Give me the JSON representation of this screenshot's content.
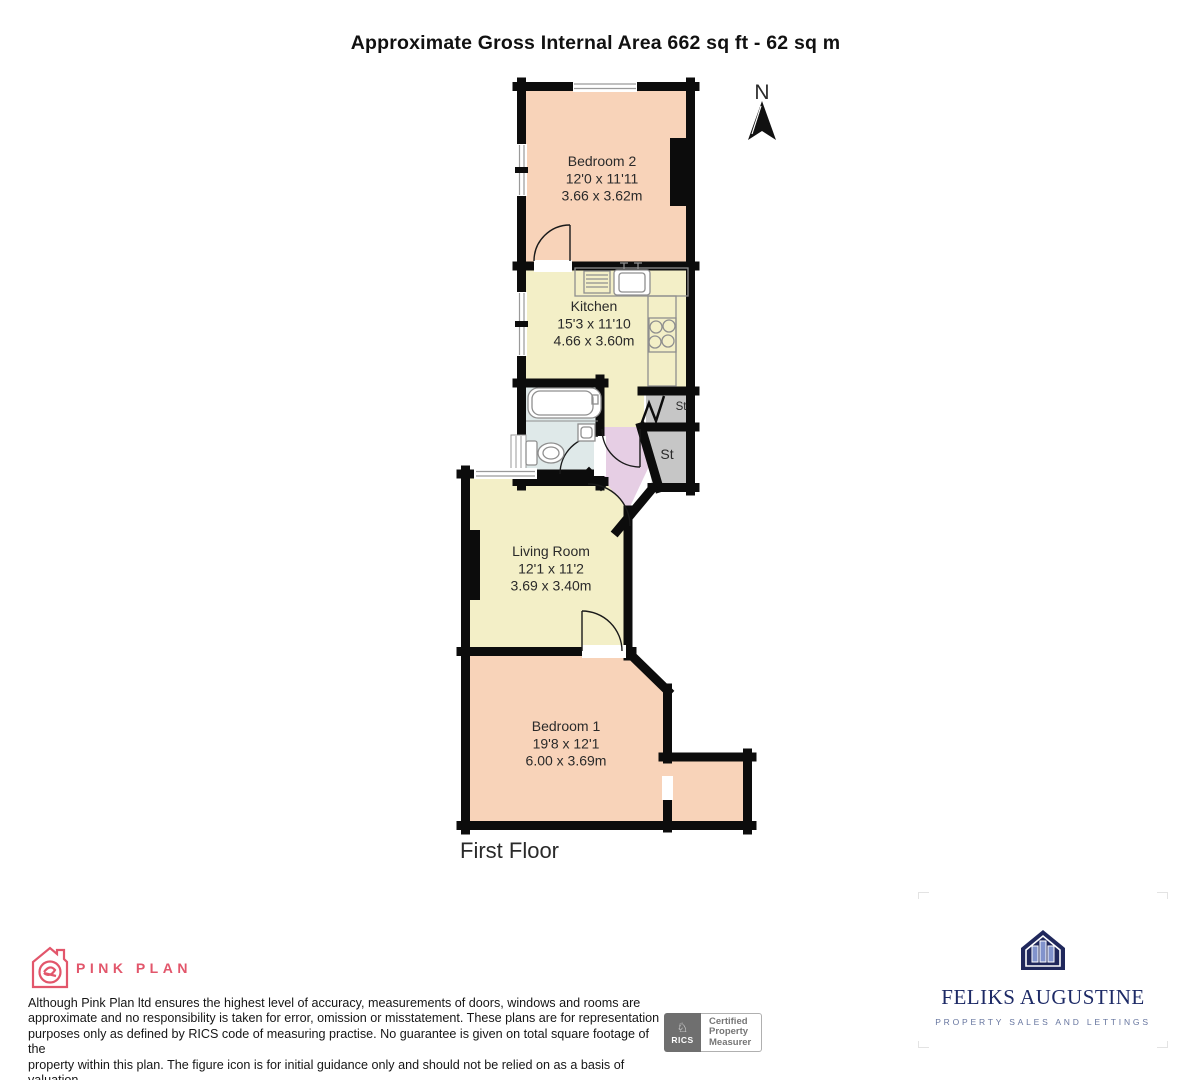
{
  "title": "Approximate Gross Internal Area 662 sq ft - 62 sq m",
  "floor_label": "First Floor",
  "compass_label": "N",
  "rooms": [
    {
      "name": "Bedroom 2",
      "imperial": "12'0 x 11'11",
      "metric": "3.66 x 3.62m"
    },
    {
      "name": "Kitchen",
      "imperial": "15'3 x 11'10",
      "metric": "4.66 x 3.60m"
    },
    {
      "name": "Living Room",
      "imperial": "12'1 x 11'2",
      "metric": "3.69 x 3.40m"
    },
    {
      "name": "Bedroom 1",
      "imperial": "19'8 x 12'1",
      "metric": "6.00 x 3.69m"
    }
  ],
  "storage": {
    "small": "St",
    "large": "St"
  },
  "colors": {
    "bedroom": "#f8d3b9",
    "kitchen_living": "#f3efc7",
    "bathroom": "#dfe9e9",
    "hallway": "#e6cee4",
    "storage": "#c6c6c6",
    "wall": "#0c0c0c",
    "pink": "#e2566b",
    "navy": "#1d2a66"
  },
  "footer": {
    "pink_plan": {
      "brand": "PINK PLAN"
    },
    "disclaimer": {
      "lines": [
        "Although Pink Plan ltd ensures the highest level of accuracy, measurements of doors, windows and rooms are",
        "approximate and no responsibility is taken for error, omission or misstatement. These plans are for representation",
        "purposes only as defined by RICS code of measuring practise. No guarantee is given on total square footage of the",
        "property within this plan. The figure icon is for initial guidance only and should not be relied on as a basis of valuation."
      ]
    },
    "rics": {
      "brand": "RICS",
      "cert_lines": [
        "Certified",
        "Property",
        "Measurer"
      ]
    },
    "agency": {
      "name": "FELIKS AUGUSTINE",
      "tagline": "PROPERTY SALES AND LETTINGS"
    }
  }
}
